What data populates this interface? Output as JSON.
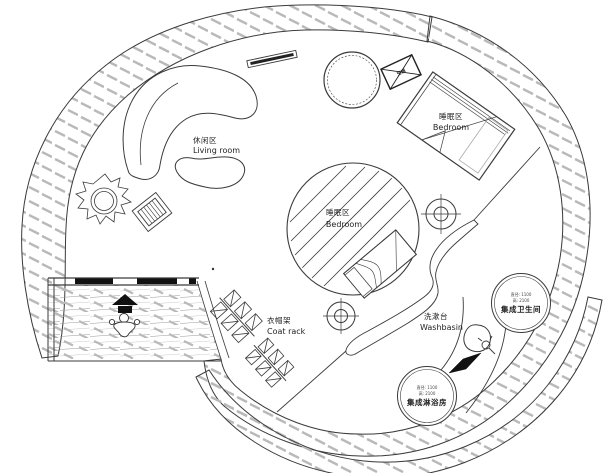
{
  "labels": {
    "living_area": {
      "zh": "休闲区",
      "en": "Living room"
    },
    "bedroom_upper": {
      "zh": "睡眠区",
      "en": "Bedroom"
    },
    "bedroom_center": {
      "zh": "睡眠区",
      "en": "Bedroom"
    },
    "coat_rack": {
      "zh": "衣帽架",
      "en": "Coat rack"
    },
    "washbasin": {
      "zh": "洗漱台",
      "en": "Washbasin"
    },
    "toilet_pod": {
      "spec_diameter": "直径: 1100",
      "spec_height": "高: 2100",
      "name": "集成卫生间"
    },
    "shower_pod": {
      "spec_diameter": "直径: 1100",
      "spec_height": "高: 2100",
      "name": "集成淋浴房"
    },
    "ac_unit": {
      "zh": "空调"
    }
  },
  "colors": {
    "line": "#3a3a3a",
    "hatch": "#b9b9b9",
    "solid_black": "#111111",
    "background": "#ffffff"
  }
}
